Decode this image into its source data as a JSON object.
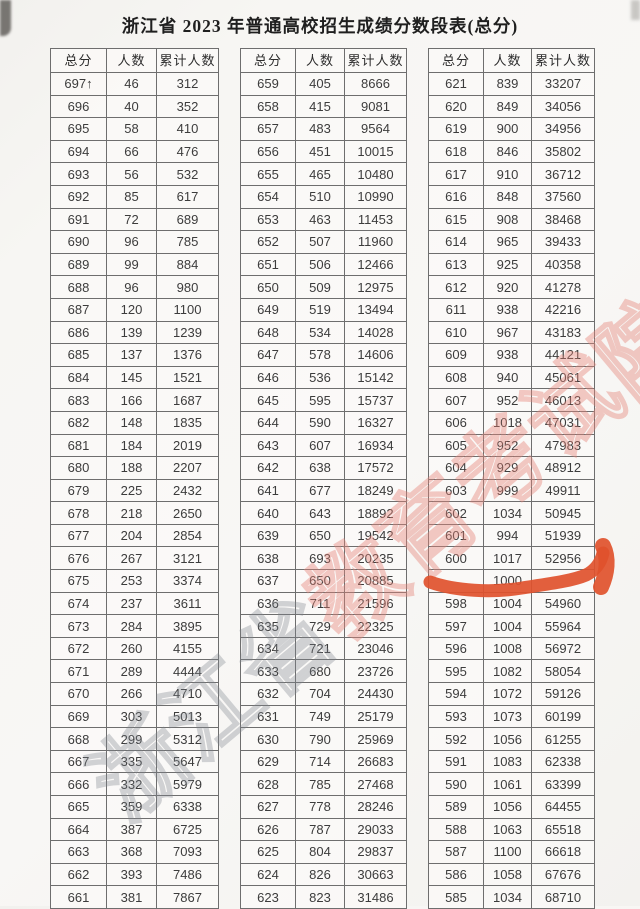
{
  "title": "浙江省 2023 年普通高校招生成绩分数段表(总分)",
  "columns": [
    "总分",
    "人数",
    "累计人数"
  ],
  "tables": [
    {
      "name": "score-table-left",
      "rows": [
        [
          "697↑",
          "46",
          "312"
        ],
        [
          "696",
          "40",
          "352"
        ],
        [
          "695",
          "58",
          "410"
        ],
        [
          "694",
          "66",
          "476"
        ],
        [
          "693",
          "56",
          "532"
        ],
        [
          "692",
          "85",
          "617"
        ],
        [
          "691",
          "72",
          "689"
        ],
        [
          "690",
          "96",
          "785"
        ],
        [
          "689",
          "99",
          "884"
        ],
        [
          "688",
          "96",
          "980"
        ],
        [
          "687",
          "120",
          "1100"
        ],
        [
          "686",
          "139",
          "1239"
        ],
        [
          "685",
          "137",
          "1376"
        ],
        [
          "684",
          "145",
          "1521"
        ],
        [
          "683",
          "166",
          "1687"
        ],
        [
          "682",
          "148",
          "1835"
        ],
        [
          "681",
          "184",
          "2019"
        ],
        [
          "680",
          "188",
          "2207"
        ],
        [
          "679",
          "225",
          "2432"
        ],
        [
          "678",
          "218",
          "2650"
        ],
        [
          "677",
          "204",
          "2854"
        ],
        [
          "676",
          "267",
          "3121"
        ],
        [
          "675",
          "253",
          "3374"
        ],
        [
          "674",
          "237",
          "3611"
        ],
        [
          "673",
          "284",
          "3895"
        ],
        [
          "672",
          "260",
          "4155"
        ],
        [
          "671",
          "289",
          "4444"
        ],
        [
          "670",
          "266",
          "4710"
        ],
        [
          "669",
          "303",
          "5013"
        ],
        [
          "668",
          "299",
          "5312"
        ],
        [
          "667",
          "335",
          "5647"
        ],
        [
          "666",
          "332",
          "5979"
        ],
        [
          "665",
          "359",
          "6338"
        ],
        [
          "664",
          "387",
          "6725"
        ],
        [
          "663",
          "368",
          "7093"
        ],
        [
          "662",
          "393",
          "7486"
        ],
        [
          "661",
          "381",
          "7867"
        ]
      ]
    },
    {
      "name": "score-table-middle",
      "rows": [
        [
          "659",
          "405",
          "8666"
        ],
        [
          "658",
          "415",
          "9081"
        ],
        [
          "657",
          "483",
          "9564"
        ],
        [
          "656",
          "451",
          "10015"
        ],
        [
          "655",
          "465",
          "10480"
        ],
        [
          "654",
          "510",
          "10990"
        ],
        [
          "653",
          "463",
          "11453"
        ],
        [
          "652",
          "507",
          "11960"
        ],
        [
          "651",
          "506",
          "12466"
        ],
        [
          "650",
          "509",
          "12975"
        ],
        [
          "649",
          "519",
          "13494"
        ],
        [
          "648",
          "534",
          "14028"
        ],
        [
          "647",
          "578",
          "14606"
        ],
        [
          "646",
          "536",
          "15142"
        ],
        [
          "645",
          "595",
          "15737"
        ],
        [
          "644",
          "590",
          "16327"
        ],
        [
          "643",
          "607",
          "16934"
        ],
        [
          "642",
          "638",
          "17572"
        ],
        [
          "641",
          "677",
          "18249"
        ],
        [
          "640",
          "643",
          "18892"
        ],
        [
          "639",
          "650",
          "19542"
        ],
        [
          "638",
          "693",
          "20235"
        ],
        [
          "637",
          "650",
          "20885"
        ],
        [
          "636",
          "711",
          "21596"
        ],
        [
          "635",
          "729",
          "22325"
        ],
        [
          "634",
          "721",
          "23046"
        ],
        [
          "633",
          "680",
          "23726"
        ],
        [
          "632",
          "704",
          "24430"
        ],
        [
          "631",
          "749",
          "25179"
        ],
        [
          "630",
          "790",
          "25969"
        ],
        [
          "629",
          "714",
          "26683"
        ],
        [
          "628",
          "785",
          "27468"
        ],
        [
          "627",
          "778",
          "28246"
        ],
        [
          "626",
          "787",
          "29033"
        ],
        [
          "625",
          "804",
          "29837"
        ],
        [
          "624",
          "826",
          "30663"
        ],
        [
          "623",
          "823",
          "31486"
        ]
      ]
    },
    {
      "name": "score-table-right",
      "rows": [
        [
          "621",
          "839",
          "33207"
        ],
        [
          "620",
          "849",
          "34056"
        ],
        [
          "619",
          "900",
          "34956"
        ],
        [
          "618",
          "846",
          "35802"
        ],
        [
          "617",
          "910",
          "36712"
        ],
        [
          "616",
          "848",
          "37560"
        ],
        [
          "615",
          "908",
          "38468"
        ],
        [
          "614",
          "965",
          "39433"
        ],
        [
          "613",
          "925",
          "40358"
        ],
        [
          "612",
          "920",
          "41278"
        ],
        [
          "611",
          "938",
          "42216"
        ],
        [
          "610",
          "967",
          "43183"
        ],
        [
          "609",
          "938",
          "44121"
        ],
        [
          "608",
          "940",
          "45061"
        ],
        [
          "607",
          "952",
          "46013"
        ],
        [
          "606",
          "1018",
          "47031"
        ],
        [
          "605",
          "952",
          "47983"
        ],
        [
          "604",
          "929",
          "48912"
        ],
        [
          "603",
          "999",
          "49911"
        ],
        [
          "602",
          "1034",
          "50945"
        ],
        [
          "601",
          "994",
          "51939"
        ],
        [
          "600",
          "1017",
          "52956"
        ],
        [
          "",
          "1000",
          ""
        ],
        [
          "598",
          "1004",
          "54960"
        ],
        [
          "597",
          "1004",
          "55964"
        ],
        [
          "596",
          "1008",
          "56972"
        ],
        [
          "595",
          "1082",
          "58054"
        ],
        [
          "594",
          "1072",
          "59126"
        ],
        [
          "593",
          "1073",
          "60199"
        ],
        [
          "592",
          "1056",
          "61255"
        ],
        [
          "591",
          "1083",
          "62338"
        ],
        [
          "590",
          "1061",
          "63399"
        ],
        [
          "589",
          "1056",
          "64455"
        ],
        [
          "588",
          "1063",
          "65518"
        ],
        [
          "587",
          "1100",
          "66618"
        ],
        [
          "586",
          "1058",
          "67676"
        ],
        [
          "585",
          "1034",
          "68710"
        ]
      ]
    }
  ],
  "watermark": {
    "text_gray": "浙江省",
    "text_pink": "教育考试院",
    "gray_color": "#7d848c",
    "pink_color": "#e48276"
  },
  "annotation": {
    "type": "red-marker-stroke",
    "color": "#e0512d",
    "note_partially_visible_value": "1000"
  }
}
